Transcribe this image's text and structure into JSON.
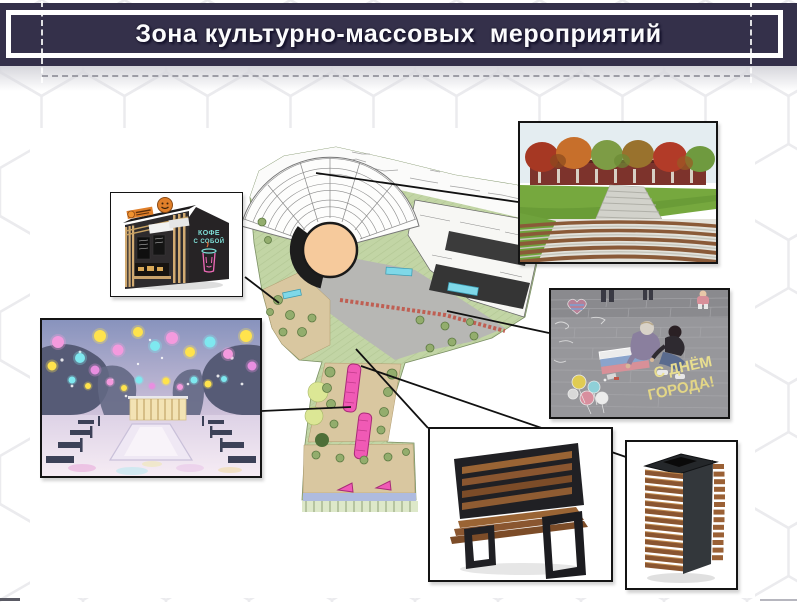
{
  "title": {
    "text": "Зона культурно-массовых  мероприятий"
  },
  "kiosk_photo": {
    "neon_sign_line1": "КОФЕ",
    "neon_sign_line2": "С СОБОЙ"
  },
  "chalk_photo": {
    "chalk_text_line1": "С ДНЁМ",
    "chalk_text_line2": "ГОРОДА!"
  },
  "colors": {
    "banner_bg": "#34304a",
    "plan_green": "#c2d5a5",
    "plan_pink": "#f05ab5",
    "plan_stage": "#f6ca9c",
    "wood": "#8a5530",
    "neon_teal": "#7fe0d8",
    "neon_pink": "#f06ab8"
  }
}
